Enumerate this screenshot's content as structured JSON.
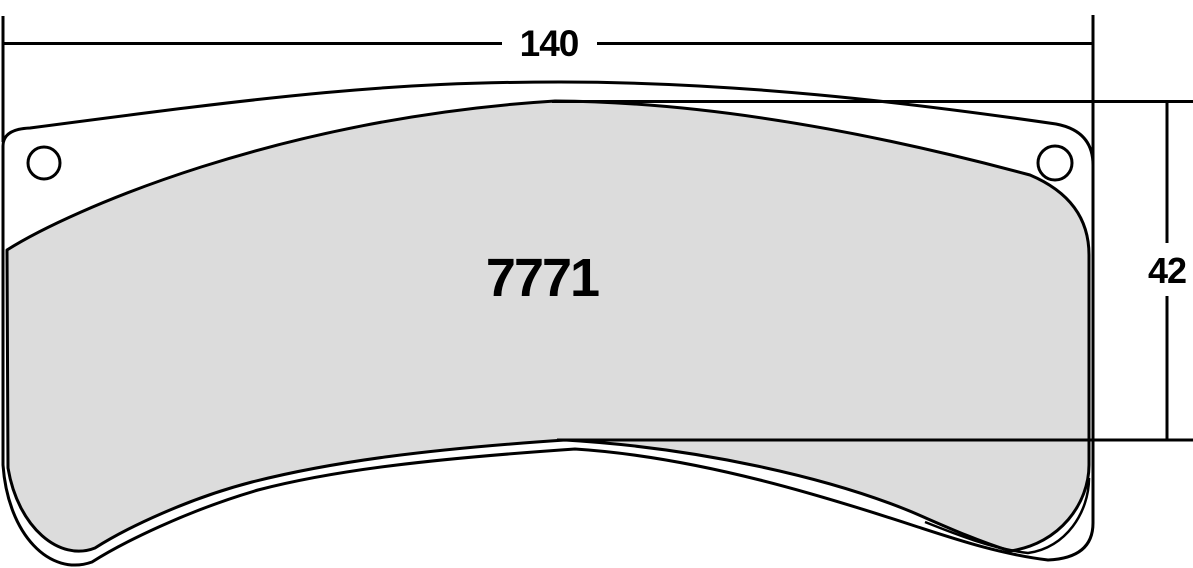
{
  "drawing": {
    "part_number": "7771",
    "width_dimension": "140",
    "height_dimension": "42",
    "colors": {
      "outline": "#000000",
      "friction_fill": "#dcdcdc",
      "plate_fill": "#ffffff",
      "background": "#ffffff"
    }
  }
}
